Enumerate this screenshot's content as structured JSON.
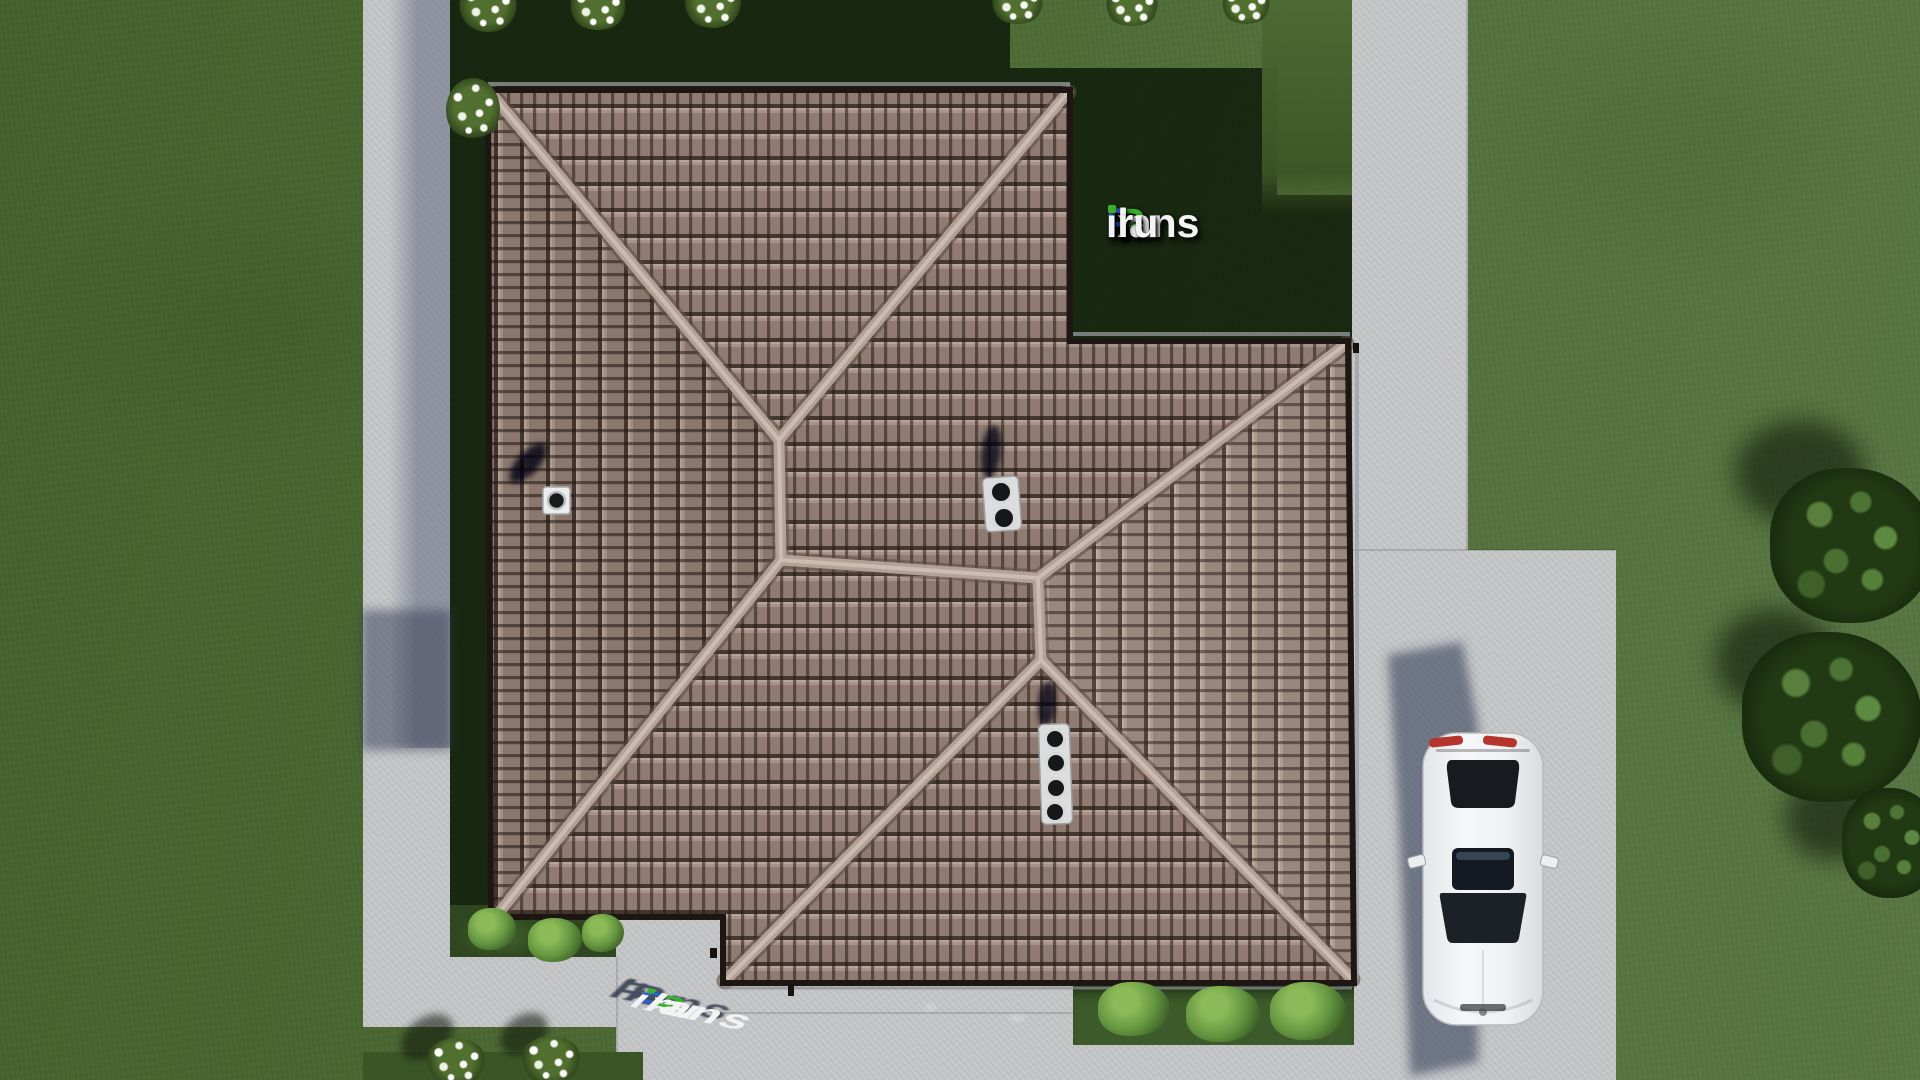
{
  "brand": {
    "site": "FixPlans.ru",
    "logo_parts": [
      {
        "text": "F",
        "color": "#2c5ed6"
      },
      {
        "text": "i",
        "color": "#f3f3f3",
        "dot_color": "#38b02a"
      },
      {
        "text": "x",
        "color": "#f3f3f3"
      },
      {
        "text": "P",
        "color": "#38b02a"
      },
      {
        "text": "lans",
        "color": "#f3f3f3"
      },
      {
        "text": ".",
        "color": "#37a5e6"
      },
      {
        "text": "ru",
        "color": "#f3f3f3"
      }
    ]
  },
  "scene": {
    "description": "Aerial top-down 3D render of a house with a brown tiled hip roof, concrete walkways, driveway with a parked white sedan, lawn, flower shrubs and trees",
    "objects": {
      "roof": "brown tile hip roof with tan ridge caps",
      "roof_vents": [
        "white box vent on west slope",
        "double steel pipe vent near center",
        "quad steel pipe vent on south wing"
      ],
      "car": "white sedan parked on driveway, viewed from above",
      "paths": "light concrete walkway left and right, driveway bottom right, terrace below house",
      "planting": [
        "white flower shrubs along edges",
        "light green shrubs at house corners",
        "dark green trees at right edge"
      ]
    }
  },
  "palette": {
    "grass": "#4d6a35",
    "grass_shadow": "#15230e",
    "pavement": "#c5c6c8",
    "pavement_shadow": "#48506a",
    "roof_tile": "#8f7b71",
    "roof_gap": "#241912",
    "roof_ridge": "#b3a197",
    "roof_eave": "#1d1613",
    "car_body": "#f2f3f5",
    "car_shadow": "#2a3450",
    "tree": "#16280d",
    "bush": "#649540",
    "accent_blue": "#2c5ed6",
    "accent_green": "#38b02a",
    "accent_cyan": "#37a5e6"
  }
}
